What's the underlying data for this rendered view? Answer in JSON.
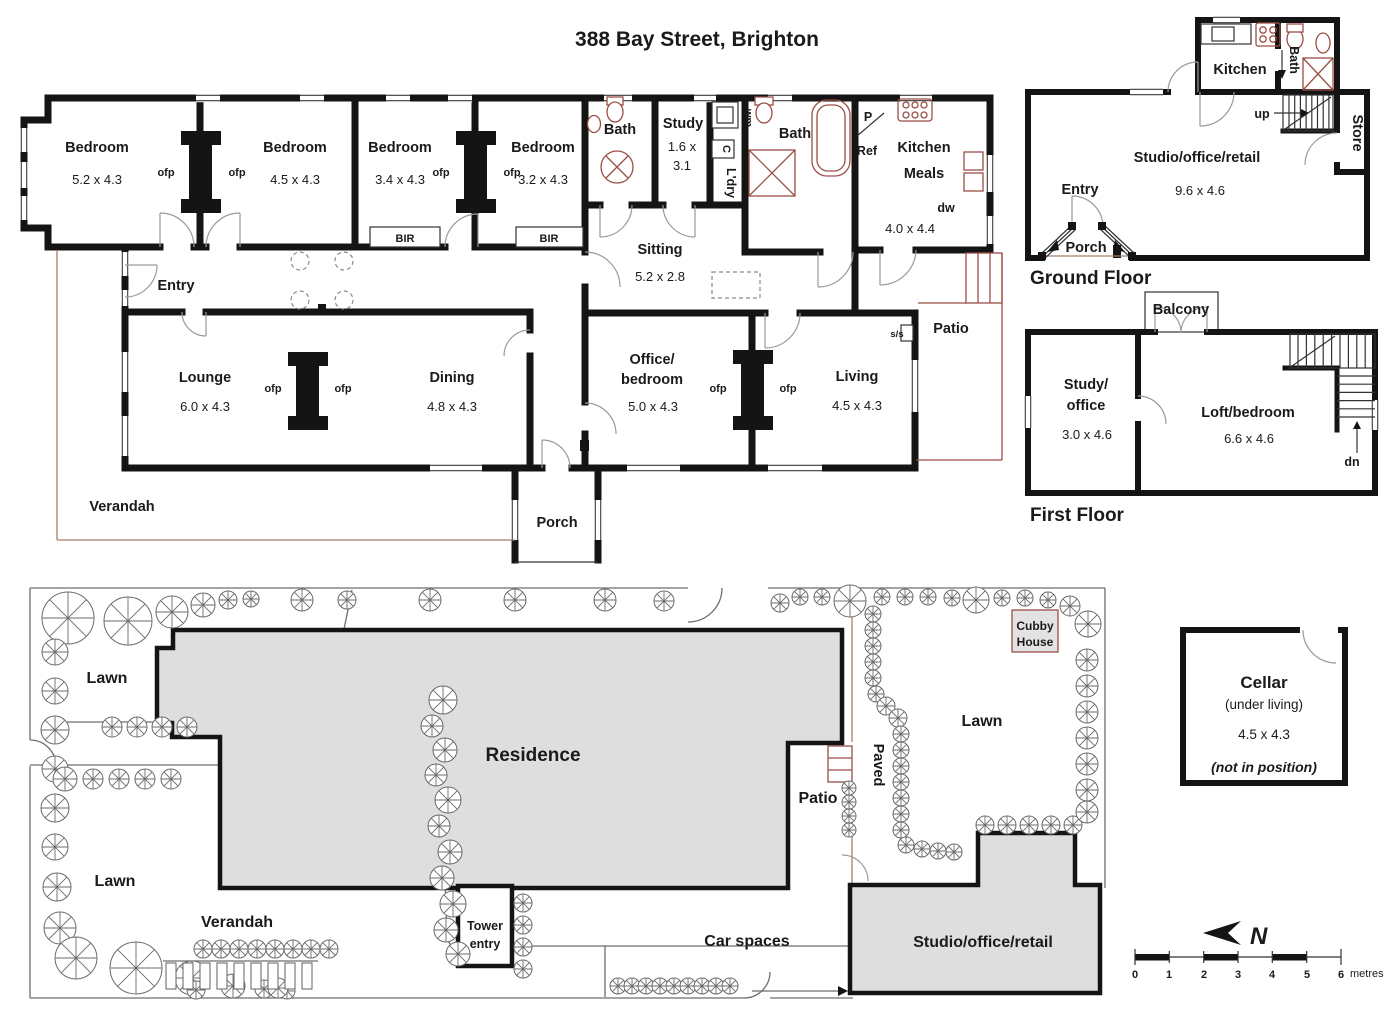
{
  "title": "388 Bay Street, Brighton",
  "colors": {
    "wall": "#141414",
    "fixture": "#9a4f45",
    "building_fill": "#dedede",
    "verandah_line": "#a5806b"
  },
  "main_floor": {
    "bedrooms": [
      {
        "name": "Bedroom",
        "dims": "5.2 x 4.3"
      },
      {
        "name": "Bedroom",
        "dims": "4.5 x 4.3"
      },
      {
        "name": "Bedroom",
        "dims": "3.4 x 4.3"
      },
      {
        "name": "Bedroom",
        "dims": "3.2 x 4.3"
      }
    ],
    "ofp": "ofp",
    "bir": "BIR",
    "bath1": "Bath",
    "bath2": "Bath",
    "study": {
      "name": "Study",
      "dims1": "1.6 x",
      "dims2": "3.1"
    },
    "laundry": {
      "name": "L'dry",
      "wm": "wm",
      "c": "C"
    },
    "pantry": "P",
    "ref": "Ref",
    "kitchen": {
      "line1": "Kitchen",
      "line2": "Meals",
      "dims": "4.0 x 4.4",
      "dw": "dw"
    },
    "sitting": {
      "name": "Sitting",
      "dims": "5.2 x 2.8"
    },
    "entry": "Entry",
    "lounge": {
      "name": "Lounge",
      "dims": "6.0 x 4.3"
    },
    "dining": {
      "name": "Dining",
      "dims": "4.8 x 4.3"
    },
    "office": {
      "line1": "Office/",
      "line2": "bedroom",
      "dims": "5.0 x 4.3"
    },
    "living": {
      "name": "Living",
      "dims": "4.5 x 4.3"
    },
    "ss": "s/s",
    "patio": "Patio",
    "verandah": "Verandah",
    "porch": "Porch"
  },
  "ground_floor": {
    "label": "Ground Floor",
    "kitchen": "Kitchen",
    "bath": "Bath",
    "up": "up",
    "store": "Store",
    "studio": {
      "name": "Studio/office/retail",
      "dims": "9.6 x 4.6"
    },
    "entry": "Entry",
    "porch": "Porch"
  },
  "first_floor": {
    "label": "First Floor",
    "balcony": "Balcony",
    "study": {
      "line1": "Study/",
      "line2": "office",
      "dims": "3.0 x 4.6"
    },
    "loft": {
      "name": "Loft/bedroom",
      "dims": "6.6 x 4.6"
    },
    "dn": "dn"
  },
  "site": {
    "lawn": "Lawn",
    "residence": "Residence",
    "verandah": "Verandah",
    "tower": {
      "line1": "Tower",
      "line2": "entry"
    },
    "car_spaces": "Car spaces",
    "patio": "Patio",
    "paved": "Paved",
    "cubby": {
      "line1": "Cubby",
      "line2": "House"
    },
    "studio": "Studio/office/retail"
  },
  "cellar": {
    "name": "Cellar",
    "sub": "(under living)",
    "dims": "4.5 x 4.3",
    "note": "(not in position)"
  },
  "compass": {
    "n": "N"
  },
  "scale_bar": {
    "ticks": [
      "0",
      "1",
      "2",
      "3",
      "4",
      "5",
      "6"
    ],
    "unit": "metres"
  }
}
